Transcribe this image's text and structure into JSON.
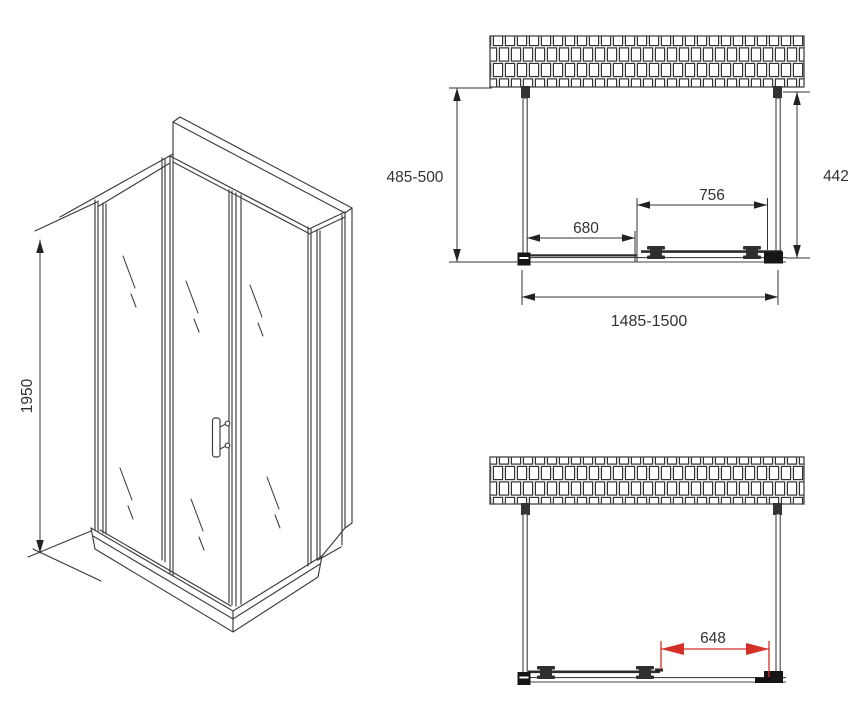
{
  "figure": {
    "type": "technical-drawing",
    "subject": "shower enclosure installation dimensions"
  },
  "iso_view": {
    "height_label": "1950"
  },
  "top_view": {
    "side_depth_label": "485-500",
    "wall_depth_label": "442",
    "door_width_label": "756",
    "fixed_panel_label": "680",
    "overall_width_label": "1485-1500"
  },
  "bottom_view": {
    "opening_width_label": "648"
  },
  "colors": {
    "line": "#3c3c3c",
    "dimension": "#333333",
    "accent_red": "#d43028",
    "background": "#ffffff"
  }
}
